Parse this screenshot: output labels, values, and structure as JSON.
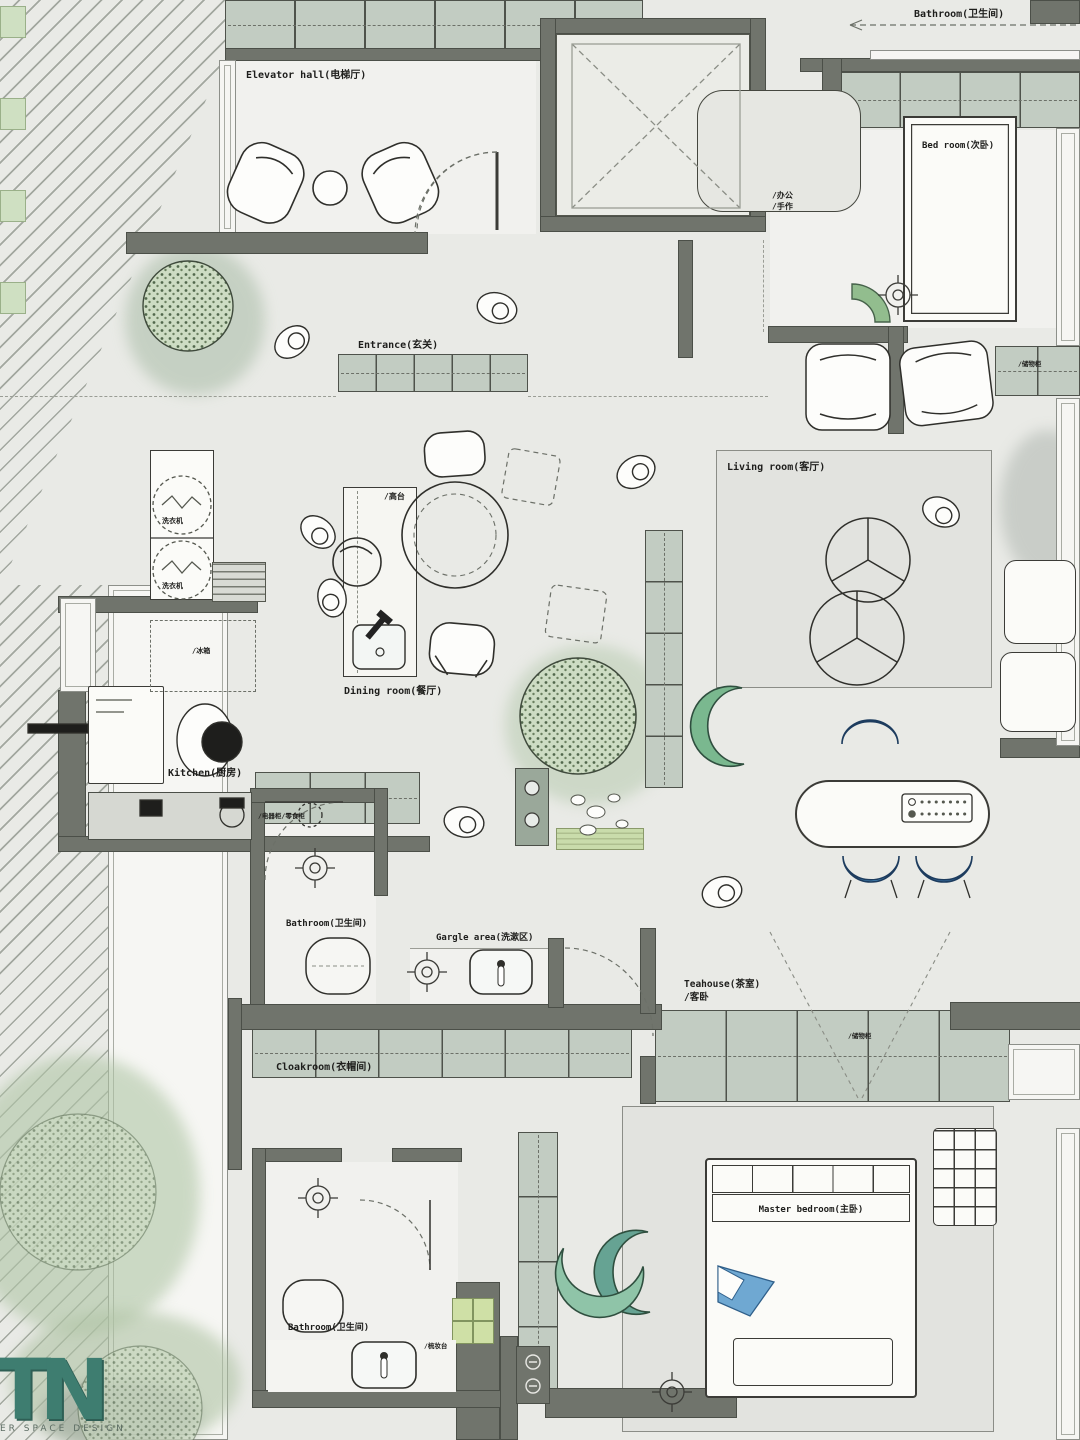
{
  "meta": {
    "title": "Apartment interior floor plan"
  },
  "logo": {
    "initials": "TN",
    "caption": "ER SPACE DESIGN"
  },
  "rooms": {
    "elevator_hall": {
      "label": "Elevator hall(电梯厅)"
    },
    "bathroom_top": {
      "label": "Bathroom(卫生间)"
    },
    "bedroom_second": {
      "label": "Bed room(次卧)"
    },
    "entrance": {
      "label": "Entrance(玄关)"
    },
    "living_room": {
      "label": "Living room(客厅)"
    },
    "dining_room": {
      "label": "Dining room(餐厅)"
    },
    "kitchen": {
      "label": "Kitchen(厨房)"
    },
    "bathroom_middle": {
      "label": "Bathroom(卫生间)"
    },
    "gargle_area": {
      "label": "Gargle area(洗漱区)"
    },
    "teahouse": {
      "label": "Teahouse(茶室)",
      "sublabel": "/客卧"
    },
    "cloakroom": {
      "label": "Cloakroom(衣帽间)"
    },
    "bathroom_lower": {
      "label": "Bathroom(卫生间)"
    },
    "master_bedroom": {
      "label": "Master bedroom(主卧)"
    }
  },
  "annotations": {
    "office": "/办公",
    "handcraft": "/手作",
    "high_counter": "/高台",
    "washer_top": "洗衣机",
    "washer_bottom": "洗衣机",
    "fridge": "/冰箱",
    "appliance_cabinet": "/电器柜/零食柜",
    "tatami_storage": "/储物柜",
    "wardrobe_right": "/储物柜",
    "dresser": "/梳妆台"
  },
  "colors": {
    "wall": "#70746c",
    "cabinet_tile": "#c2ccc2",
    "accent_teal": "#7ab88f",
    "accent_blue": "#4a90c4",
    "tree_green": "#b0c6a6",
    "logo_teal": "#3e7d70"
  }
}
